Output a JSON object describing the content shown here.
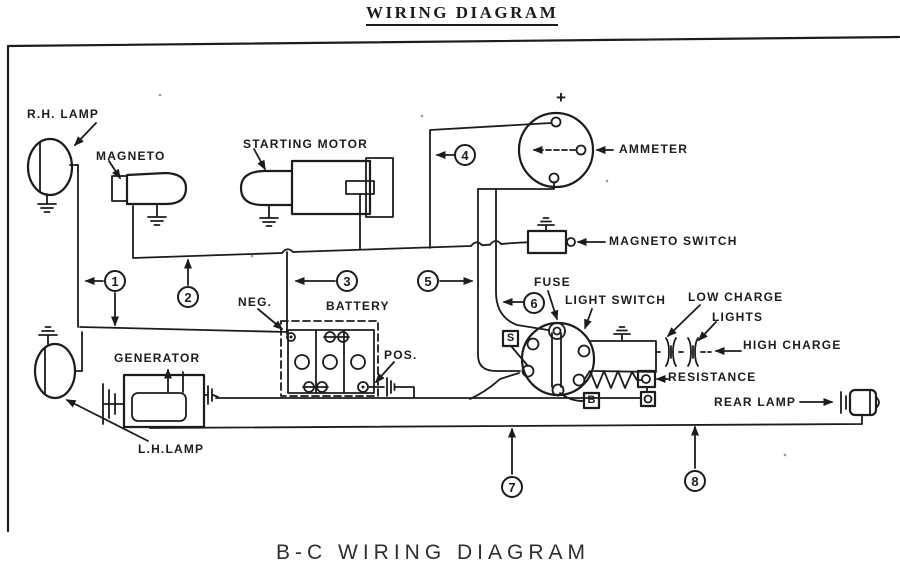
{
  "page": {
    "top_title": "WIRING DIAGRAM",
    "bottom_title": "B-C WIRING DIAGRAM"
  },
  "colors": {
    "ink": "#1c1c1c",
    "paper": "#ffffff"
  },
  "component_labels": {
    "rh_lamp": "R.H. LAMP",
    "magneto": "MAGNETO",
    "starting_motor": "STARTING MOTOR",
    "ammeter": "AMMETER",
    "ammeter_polarity": "+",
    "magneto_switch": "MAGNETO SWITCH",
    "fuse": "FUSE",
    "light_switch": "LIGHT SWITCH",
    "low_charge": "LOW CHARGE",
    "lights": "LIGHTS",
    "high_charge": "HIGH CHARGE",
    "resistance": "RESISTANCE",
    "rear_lamp": "REAR LAMP",
    "battery": "BATTERY",
    "battery_negative": "NEG.",
    "battery_positive": "POS.",
    "generator": "GENERATOR",
    "lh_lamp": "L.H.LAMP",
    "switch_terminal_s": "S",
    "switch_terminal_b": "B"
  },
  "wire_numbers": [
    "1",
    "2",
    "3",
    "4",
    "5",
    "6",
    "7",
    "8"
  ]
}
